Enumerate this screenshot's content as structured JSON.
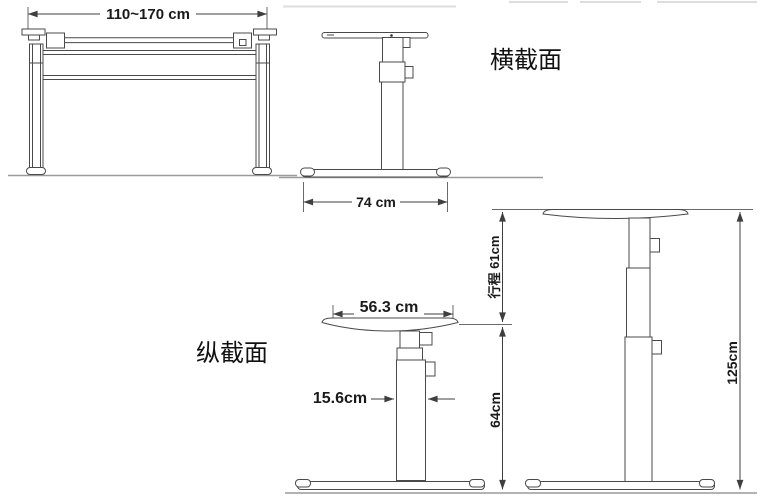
{
  "figure": {
    "type": "technical-diagram",
    "subject": "height-adjustable desk frame dimension drawing",
    "labels": {
      "cross_section": "横截面",
      "longitudinal_section": "纵截面"
    },
    "front_view": {
      "width_range": "110~170 cm"
    },
    "top_side_view": {
      "base_depth": "74 cm"
    },
    "lowered_side_view": {
      "tabletop_depth": "56.3 cm",
      "column_width": "15.6cm",
      "min_height": "64cm"
    },
    "raised_side_view": {
      "travel_stroke": "行程 61cm",
      "max_height": "125cm"
    },
    "colors": {
      "line": "#4a4a4a",
      "ground_line": "#9a9a9a",
      "text": "#1a1a1a"
    }
  }
}
